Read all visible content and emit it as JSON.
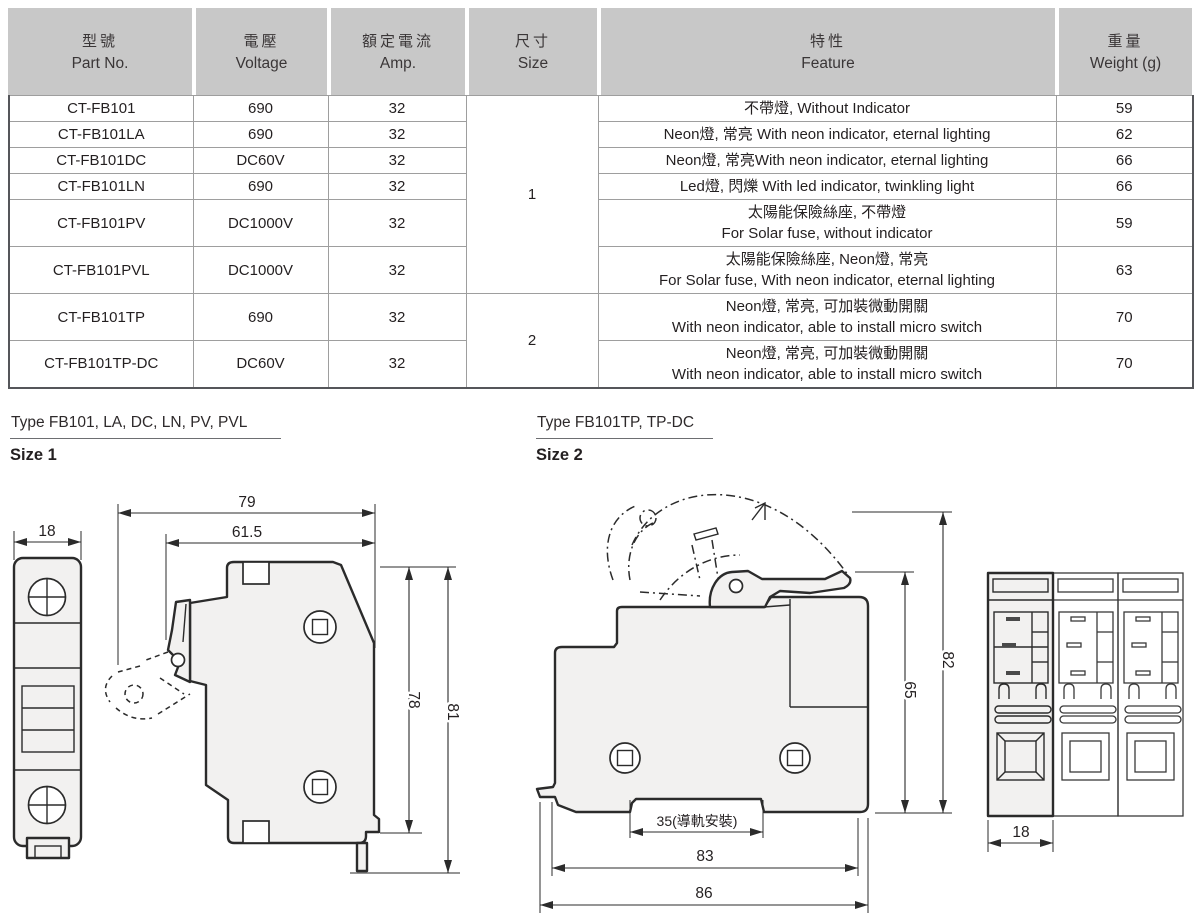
{
  "table": {
    "headers": [
      {
        "zh": "型號",
        "en": "Part No."
      },
      {
        "zh": "電壓",
        "en": "Voltage"
      },
      {
        "zh": "額定電流",
        "en": "Amp."
      },
      {
        "zh": "尺寸",
        "en": "Size"
      },
      {
        "zh": "特性",
        "en": "Feature"
      },
      {
        "zh": "重量",
        "en": "Weight (g)"
      }
    ],
    "rows": [
      {
        "part_no": "CT-FB101",
        "voltage": "690",
        "amp": "32",
        "size": "1",
        "feature1": "不帶燈, Without Indicator",
        "feature2": "",
        "weight": "59"
      },
      {
        "part_no": "CT-FB101LA",
        "voltage": "690",
        "amp": "32",
        "feature1": "Neon燈, 常亮  With neon indicator, eternal lighting",
        "feature2": "",
        "weight": "62"
      },
      {
        "part_no": "CT-FB101DC",
        "voltage": "DC60V",
        "amp": "32",
        "feature1": "Neon燈, 常亮With neon indicator, eternal lighting",
        "feature2": "",
        "weight": "66"
      },
      {
        "part_no": "CT-FB101LN",
        "voltage": "690",
        "amp": "32",
        "feature1": "Led燈, 閃爍  With led indicator, twinkling light",
        "feature2": "",
        "weight": "66"
      },
      {
        "part_no": "CT-FB101PV",
        "voltage": "DC1000V",
        "amp": "32",
        "feature1": "太陽能保險絲座, 不帶燈",
        "feature2": "For Solar fuse, without indicator",
        "weight": "59"
      },
      {
        "part_no": "CT-FB101PVL",
        "voltage": "DC1000V",
        "amp": "32",
        "feature1": "太陽能保險絲座, Neon燈, 常亮",
        "feature2": "For Solar fuse, With neon indicator, eternal lighting",
        "weight": "63"
      },
      {
        "part_no": "CT-FB101TP",
        "voltage": "690",
        "amp": "32",
        "size": "2",
        "feature1": "Neon燈, 常亮, 可加裝微動開關",
        "feature2": "With neon indicator, able to install micro switch",
        "weight": "70"
      },
      {
        "part_no": "CT-FB101TP-DC",
        "voltage": "DC60V",
        "amp": "32",
        "feature1": "Neon燈, 常亮, 可加裝微動開關",
        "feature2": "With neon indicator, able to install micro switch",
        "weight": "70"
      }
    ]
  },
  "sections": {
    "size1": {
      "type_label": "Type FB101, LA, DC, LN, PV, PVL",
      "size_label": "Size 1"
    },
    "size2": {
      "type_label": "Type FB101TP, TP-DC",
      "size_label": "Size 2"
    }
  },
  "dimensions": {
    "s1_front_width": "18",
    "s1_total_width": "79",
    "s1_body_width": "61.5",
    "s1_body_height": "78",
    "s1_total_height": "81",
    "s2_body_height": "65",
    "s2_total_height": "82",
    "s2_rail_width": "35(導軌安裝)",
    "s2_body_width": "83",
    "s2_total_width": "86",
    "s2_front_width": "18"
  },
  "colors": {
    "header_bg": "#c8c8c8",
    "outline": "#2b2b2b",
    "body_fill": "#f2f1f0"
  }
}
